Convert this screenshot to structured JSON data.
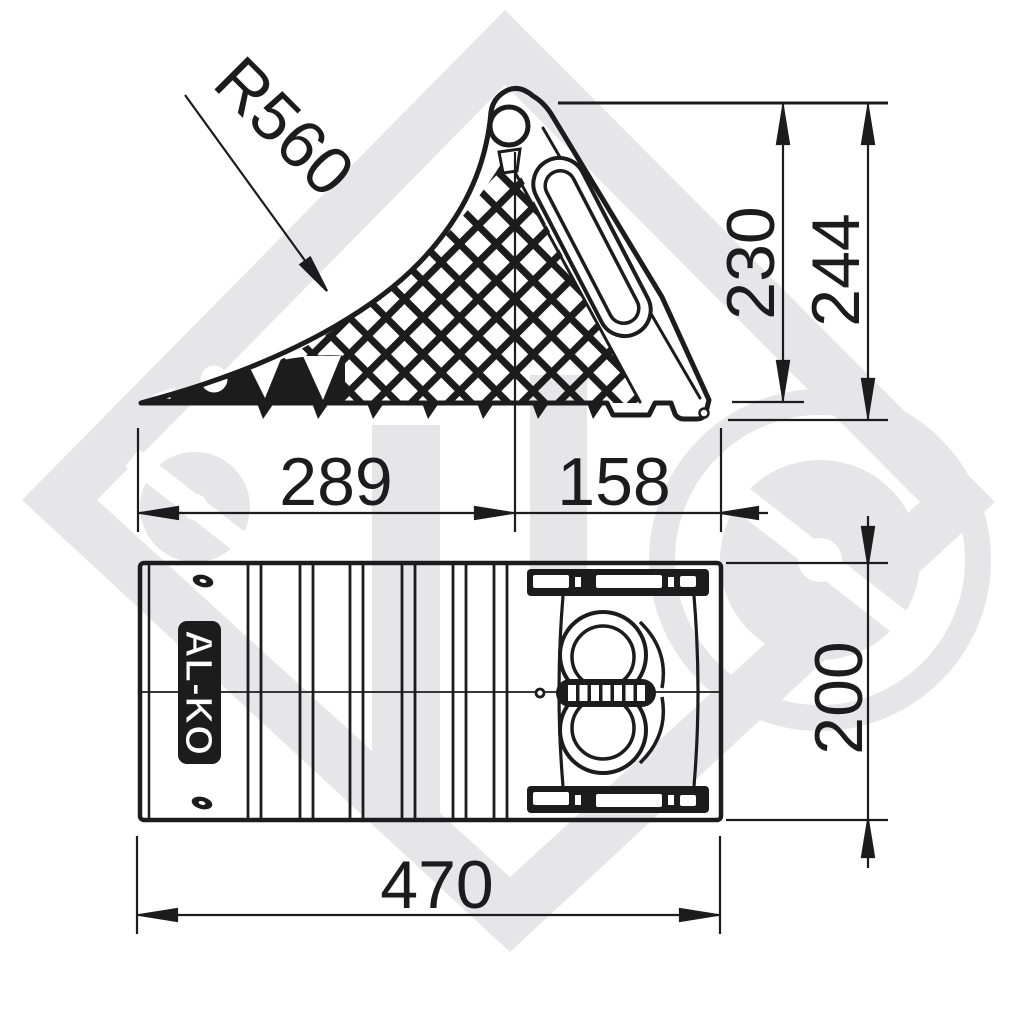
{
  "drawing": {
    "type": "technical-dimension-drawing",
    "product": "wheel chock",
    "brand_logo": "AL-KO",
    "colors": {
      "line": "#1c1c1c",
      "background": "#ffffff",
      "watermark": "#e6e6e9"
    },
    "dimensions": {
      "radius": "R560",
      "wedge_height": "230",
      "total_height": "244",
      "slope_length": "289",
      "rear_length": "158",
      "total_length": "470",
      "width": "200"
    }
  }
}
